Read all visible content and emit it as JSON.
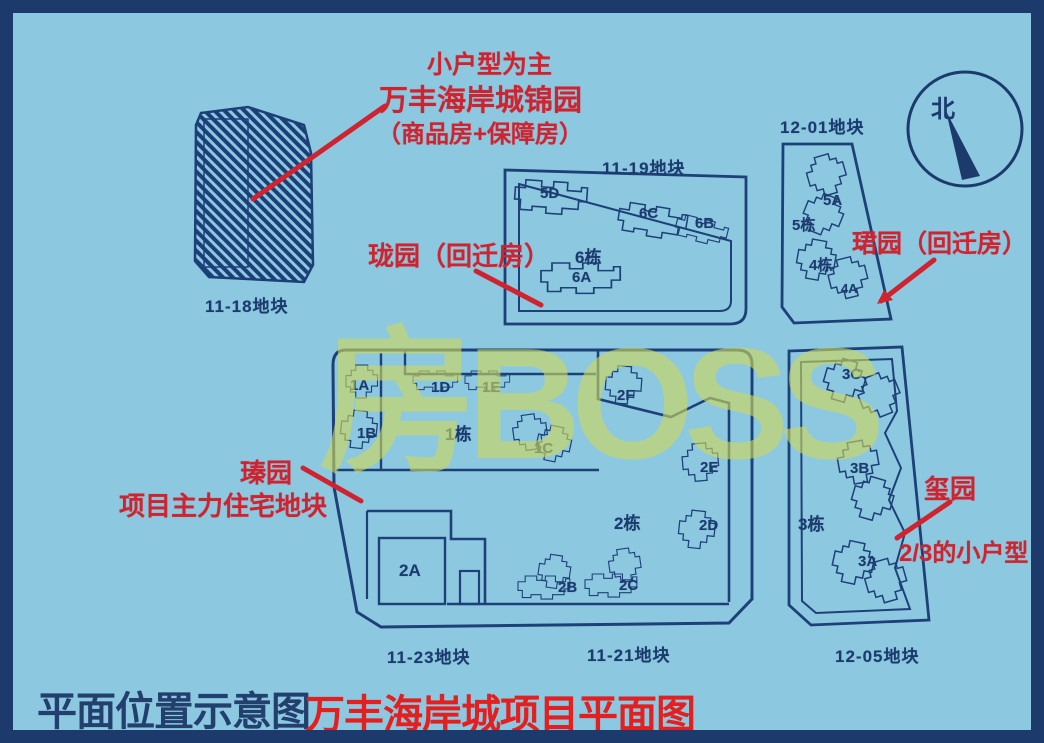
{
  "watermark": "房BOSS",
  "compass": {
    "north": "北"
  },
  "footer": {
    "subtitle": "平面位置示意图",
    "title": "万丰海岸城项目平面图"
  },
  "annotations": {
    "jinyuan": {
      "line1": "小户型为主",
      "line2": "万丰海岸城锦园",
      "line3": "（商品房+保障房）"
    },
    "longyuan": "珑园（回迁房）",
    "junyuan": "珺园（回迁房）",
    "zhenyuan": {
      "line1": "瑧园",
      "line2": "项目主力住宅地块"
    },
    "xiyuan": {
      "line1": "玺园",
      "line2": "2/3的小户型"
    }
  },
  "plots": {
    "p1118": "11-18地块",
    "p1119": "11-19地块",
    "p1201": "12-01地块",
    "p1123": "11-23地块",
    "p1121": "11-21地块",
    "p1205": "12-05地块"
  },
  "buildings": {
    "b5d": "5D",
    "b6c": "6C",
    "b6b": "6B",
    "b6dong": "6栋",
    "b6a": "6A",
    "b5a": "5A",
    "b5dong": "5栋",
    "b4dong": "4栋",
    "b4a": "4A",
    "b1a": "1A",
    "b1d": "1D",
    "b1e": "1E",
    "b1b": "1B",
    "b1dong": "1栋",
    "b1c": "1C",
    "b2f": "2F",
    "b2e": "2E",
    "b2dong": "2栋",
    "b2d": "2D",
    "b2a": "2A",
    "b2b": "2B",
    "b2c": "2C",
    "b3c": "3C",
    "b3b": "3B",
    "b3dong": "3栋",
    "b3a": "3A"
  },
  "colors": {
    "background": "#8cc9e0",
    "frame_border": "#1d3a6c",
    "line_navy": "#1e4078",
    "annotation_red": "#cf2430",
    "title_red": "#e31f1f",
    "watermark_yellow": "#ced65c"
  }
}
